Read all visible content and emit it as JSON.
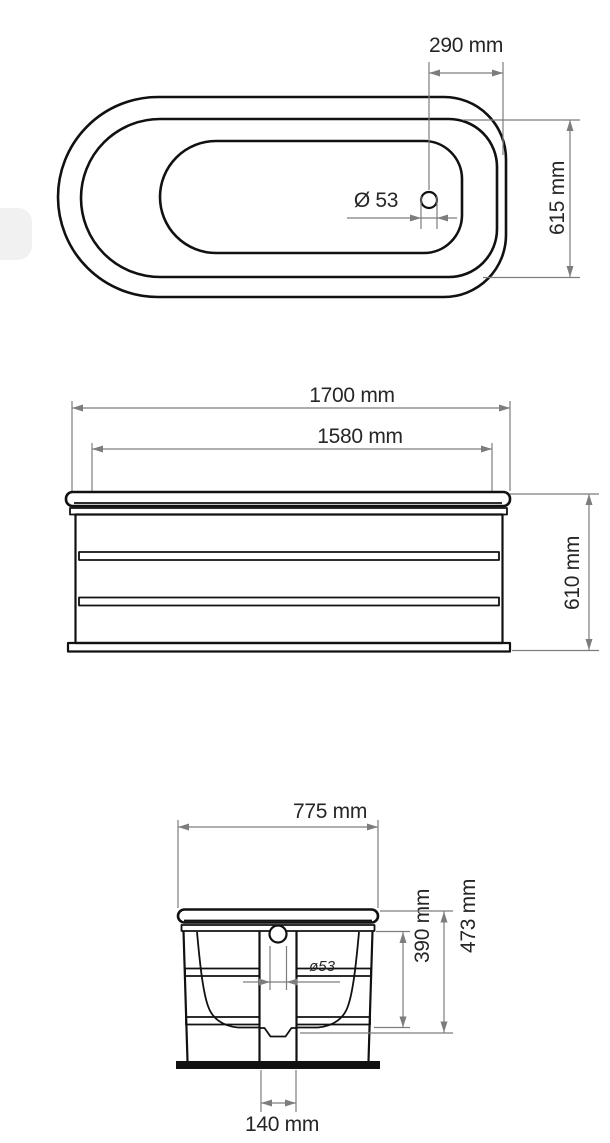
{
  "drawing": {
    "kind": "technical-drawing",
    "subject": "oval bathtub, three orthographic views with dimensions",
    "colors": {
      "background": "#ffffff",
      "outline": "#111111",
      "dimension": "#7d7d7d",
      "text": "#262626",
      "watermark": "#f1f1f1"
    },
    "views": {
      "top": {
        "name": "top view",
        "dims": {
          "drain_offset": "290 mm",
          "drain_diameter": "Ø 53",
          "width": "615 mm"
        }
      },
      "front": {
        "name": "front view",
        "dims": {
          "overall_length": "1700 mm",
          "body_length": "1580 mm",
          "height": "610 mm"
        }
      },
      "side": {
        "name": "side view",
        "dims": {
          "overall_width": "775 mm",
          "drain_diameter": "ø53",
          "inner_depth": "390 mm",
          "overall_depth": "473 mm",
          "drain_channel_width": "140 mm"
        }
      }
    }
  }
}
